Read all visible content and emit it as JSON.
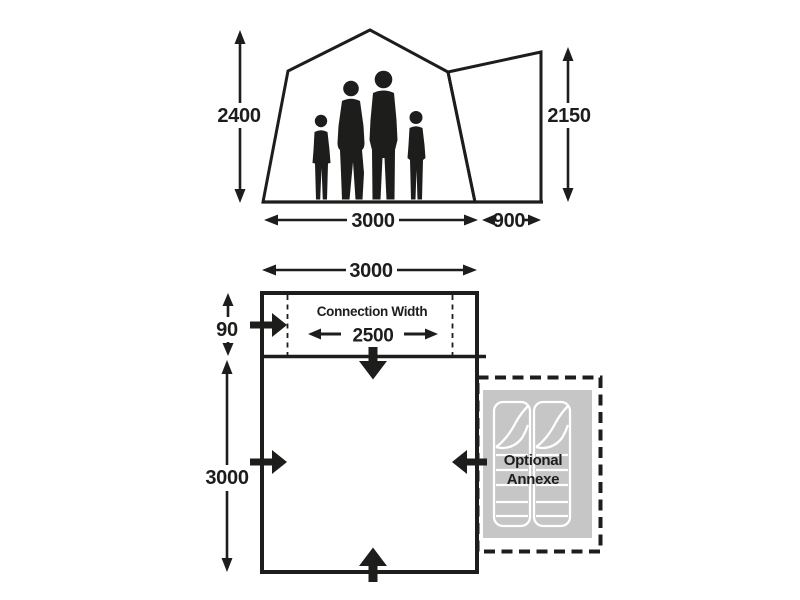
{
  "colors": {
    "ink": "#1d1d1b",
    "annexe_fill": "#c6c6c6",
    "bag_outline": "#ffffff",
    "background": "#ffffff"
  },
  "elevation": {
    "height_main": "2400",
    "height_annexe": "2150",
    "width_main": "3000",
    "width_annexe": "900"
  },
  "floorplan": {
    "width_total": "3000",
    "connection_depth": "90",
    "connection_label": "Connection Width",
    "connection_width": "2500",
    "depth_total": "3000",
    "annexe_label_line1": "Optional",
    "annexe_label_line2": "Annexe"
  }
}
